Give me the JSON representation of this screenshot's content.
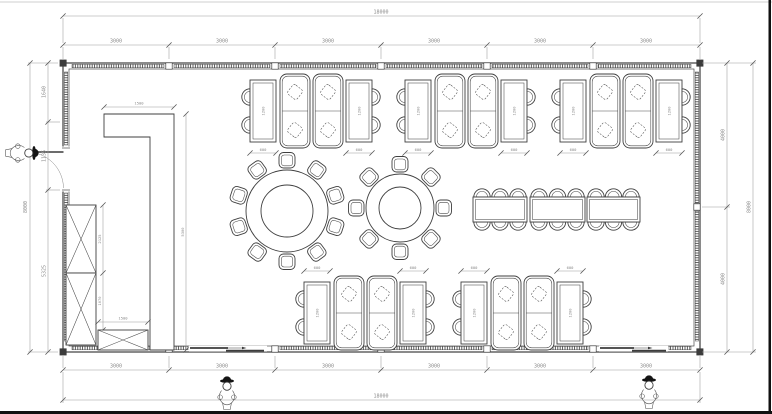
{
  "drawing": {
    "type": "restaurant-floor-plan",
    "colors": {
      "background": "#ffffff",
      "line": "#3c3c3c",
      "wall": "#4a4a4a",
      "dimension_line": "#9a9a9a",
      "dimension_text": "#8a8a8a"
    }
  },
  "dimensions": {
    "overall_width_top": "18000",
    "overall_width_bottom": "18000",
    "overall_height_left": "8000",
    "overall_height_right": "8000",
    "top_segments": [
      "3000",
      "3000",
      "3000",
      "3000",
      "3000",
      "3000"
    ],
    "bottom_segments": [
      "3000",
      "3000",
      "3000",
      "3000",
      "3000",
      "3000"
    ],
    "left_segments": [
      "1640",
      "1135",
      "5325"
    ],
    "right_segments": [
      "4000",
      "4000"
    ],
    "counter": {
      "width": "1500",
      "length": "5300"
    },
    "cabinet": {
      "upper_height": "2125",
      "lower_height": "1070",
      "bench_width": "1500"
    },
    "dining_table": {
      "width": "600",
      "length": "1200"
    }
  }
}
